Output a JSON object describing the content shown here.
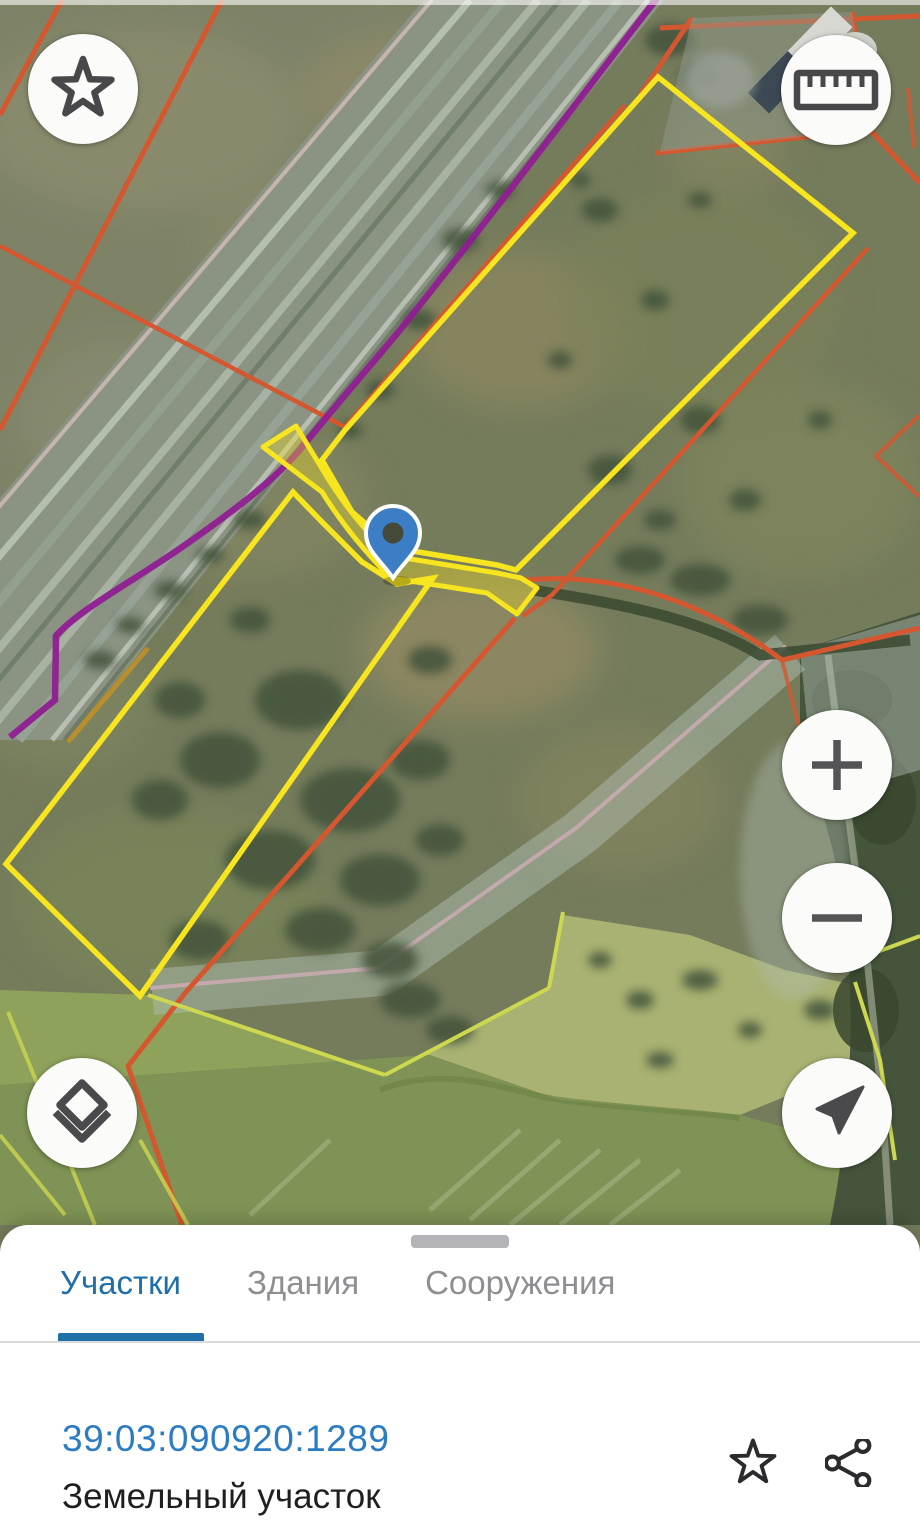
{
  "map": {
    "colors": {
      "selected_parcel": "#f7e51f",
      "cadastral_boundary": "#d4572f",
      "route_line": "#8f1d92",
      "pin": "#3b7ec6"
    },
    "pin_icon": "map-pin"
  },
  "controls": {
    "favorite_icon": "star-outline",
    "measure_icon": "ruler",
    "zoom_in_icon": "plus",
    "zoom_out_icon": "minus",
    "layers_icon": "layers",
    "locate_icon": "navigation-arrow"
  },
  "bottom_sheet": {
    "tabs": [
      {
        "label": "Участки",
        "active": true
      },
      {
        "label": "Здания",
        "active": false
      },
      {
        "label": "Сооружения",
        "active": false
      }
    ],
    "parcel": {
      "number": "39:03:090920:1289",
      "type": "Земельный участок"
    },
    "actions": {
      "favorite_icon": "star-outline",
      "share_icon": "share"
    },
    "accent_color": "#1f6fa9",
    "link_color": "#2b7cc2"
  }
}
